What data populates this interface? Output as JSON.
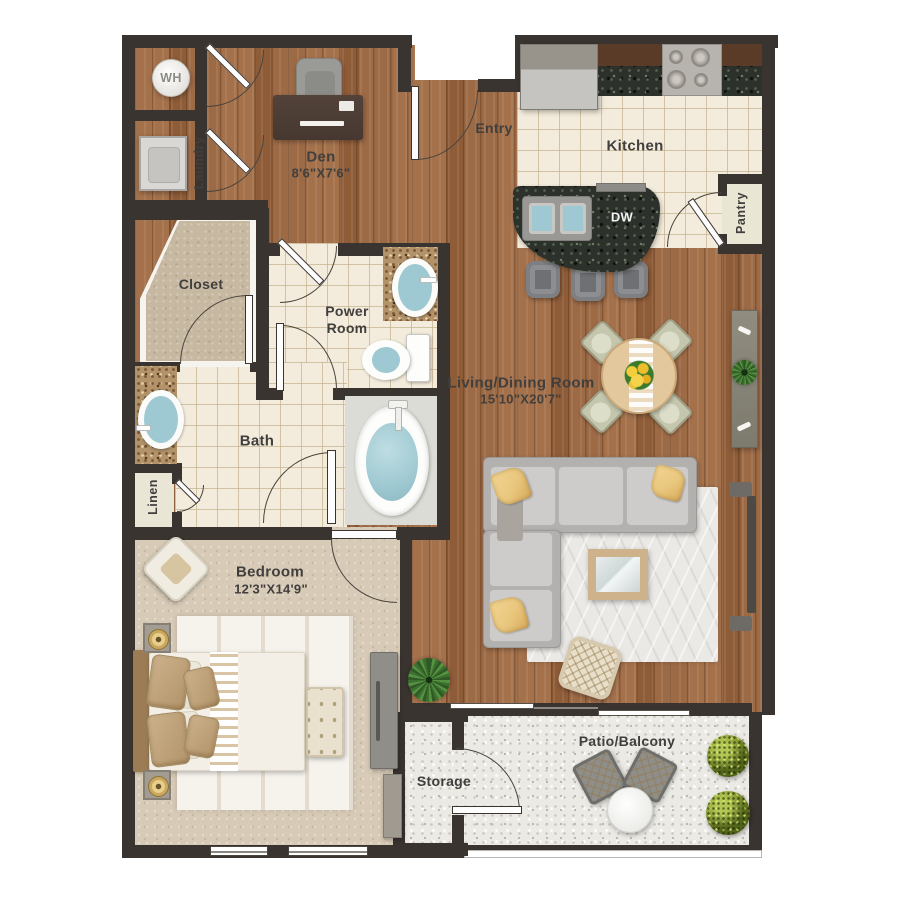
{
  "rooms": {
    "wh": {
      "label": "WH"
    },
    "laundry": {
      "label": "Laundry"
    },
    "den": {
      "label": "Den",
      "dims": "8'6\"X7'6\""
    },
    "entry": {
      "label": "Entry"
    },
    "kitchen": {
      "label": "Kitchen"
    },
    "dishwasher": {
      "label": "DW"
    },
    "pantry": {
      "label": "Pantry"
    },
    "closet": {
      "label": "Closet"
    },
    "power_room": {
      "label": "Power Room"
    },
    "bath": {
      "label": "Bath"
    },
    "linen": {
      "label": "Linen"
    },
    "living_dining": {
      "label": "Living/Dining Room",
      "dims": "15'10\"X20'7\""
    },
    "bedroom": {
      "label": "Bedroom",
      "dims": "12'3\"X14'9\""
    },
    "storage": {
      "label": "Storage"
    },
    "patio": {
      "label": "Patio/Balcony"
    }
  },
  "colors": {
    "wall": "#3a3430",
    "wood_floor": "#9d6a46",
    "kitchen_tile": "#f3ebdb",
    "closet_carpet": "#c7b8a1",
    "bedroom_carpet": "#d7cab6",
    "patio_concrete": "#eceae5",
    "granite_dark": "#2c312b",
    "granite_tan": "#b2936a",
    "counter_brown": "#5a3b28",
    "water_blue": "#9fc9d2",
    "label_text": "#413f3d",
    "accent_pillow": "#e9c77e",
    "shrub_green": "#85982f",
    "sofa_gray": "#cecccb",
    "door_white": "#fdfdfd"
  }
}
